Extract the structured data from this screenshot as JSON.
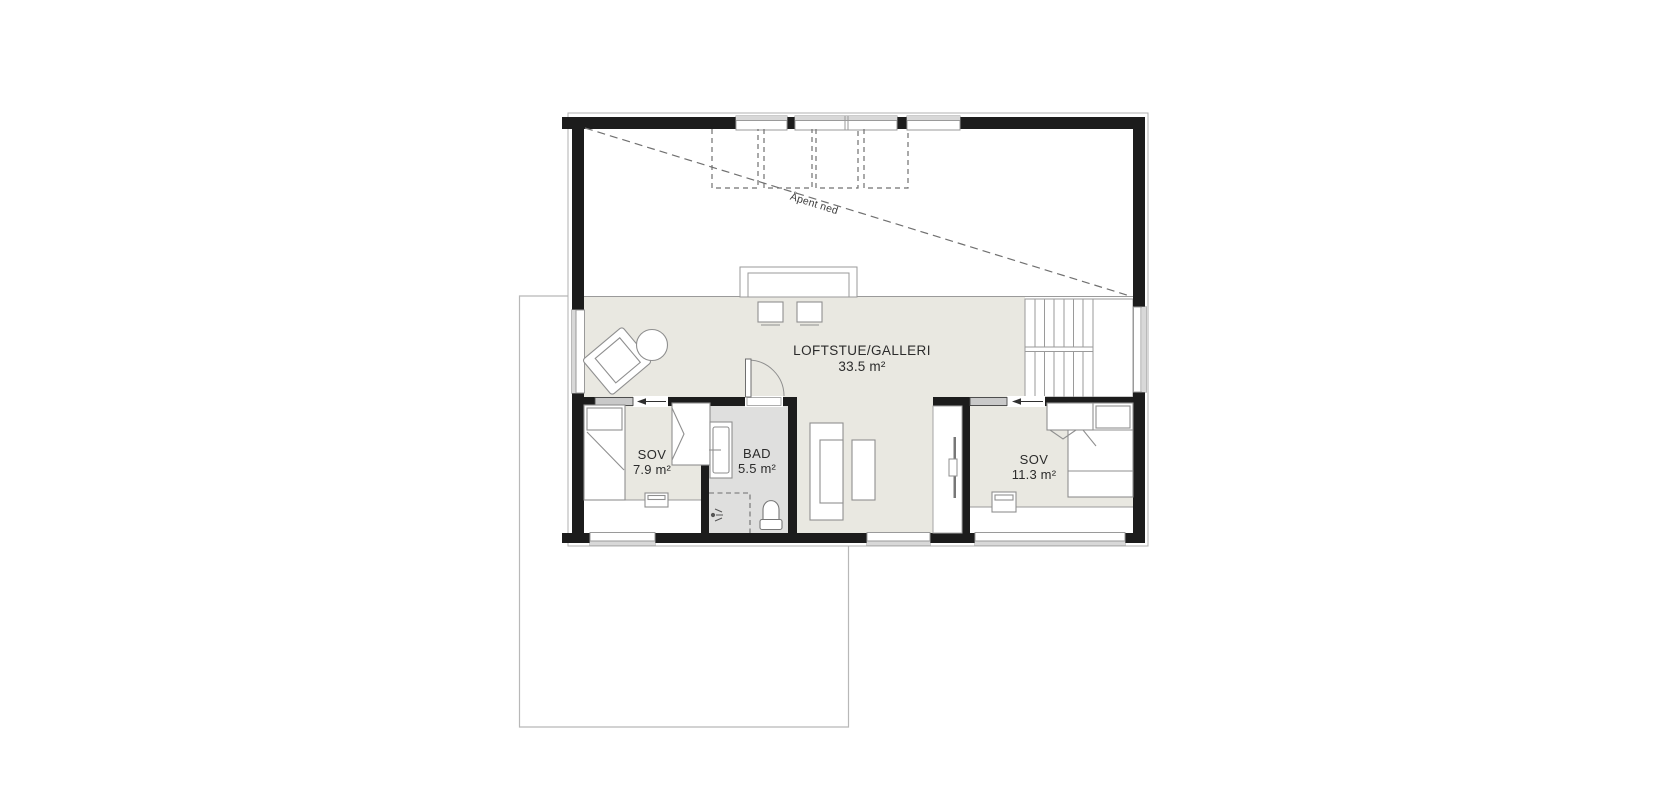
{
  "floor_plan": {
    "open_area_label": "Åpent ned",
    "rooms": [
      {
        "id": "loftstue",
        "name": "LOFTSTUE/GALLERI",
        "area": "33.5 m²"
      },
      {
        "id": "sov-left",
        "name": "SOV",
        "area": "7.9 m²"
      },
      {
        "id": "bad",
        "name": "BAD",
        "area": "5.5 m²"
      },
      {
        "id": "sov-right",
        "name": "SOV",
        "area": "11.3 m²"
      }
    ],
    "colors": {
      "wall": "#1c1c1c",
      "floor": "#e9e8e1",
      "bath_floor": "#dfdfde",
      "thin_line": "#8f8f8f",
      "window_band": "#d8d8d8",
      "dashed_line": "#707070",
      "lower_floor_outline": "#b8b8b8",
      "text": "#2b2b2b",
      "background": "#ffffff"
    }
  }
}
